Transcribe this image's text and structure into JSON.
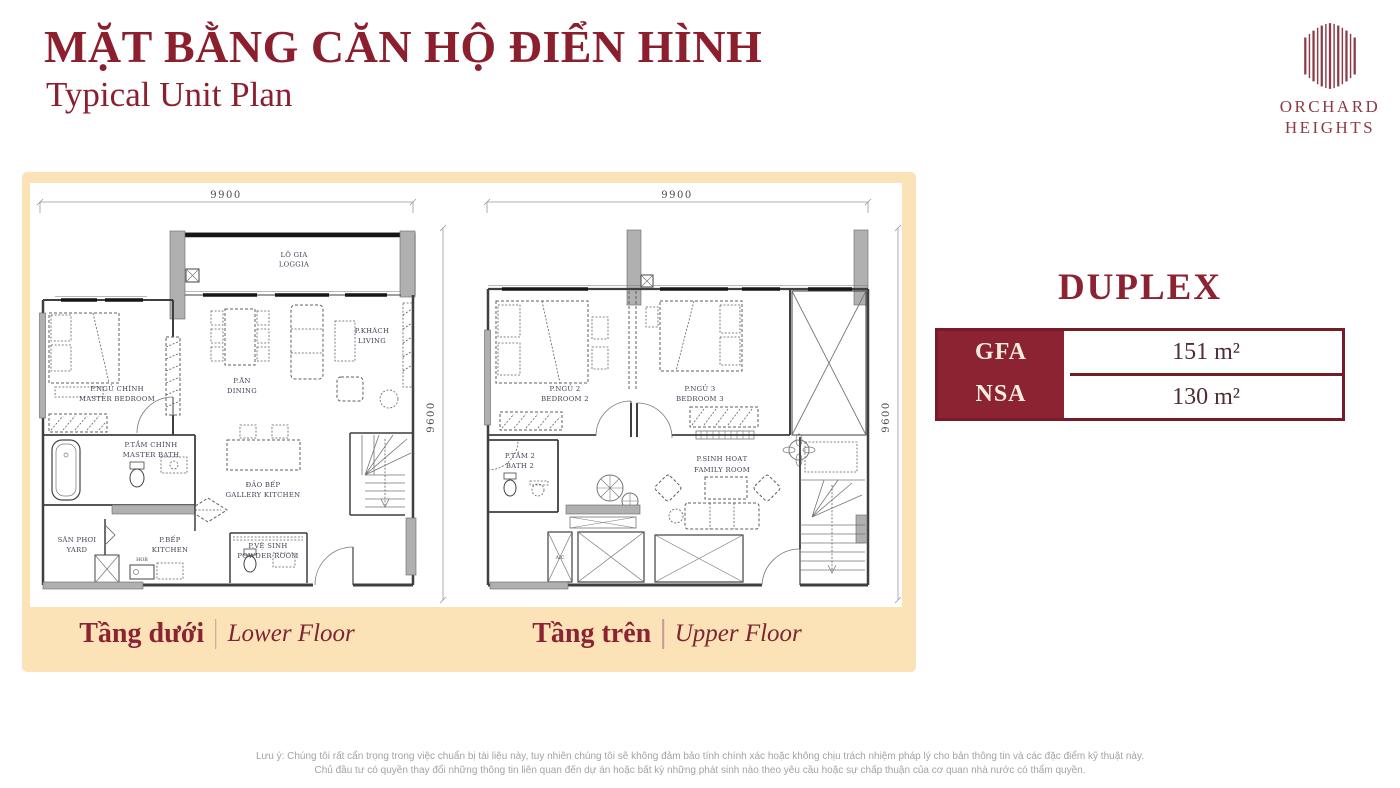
{
  "header": {
    "title_vi": "MẶT BẰNG CĂN HỘ ĐIỂN HÌNH",
    "title_en": "Typical Unit Plan"
  },
  "logo": {
    "line1": "ORCHARD",
    "line2": "HEIGHTS"
  },
  "unit": {
    "type": "DUPLEX",
    "rows": [
      {
        "label": "GFA",
        "value": "151 m²"
      },
      {
        "label": "NSA",
        "value": "130 m²"
      }
    ]
  },
  "plans": [
    {
      "name_vi": "Tầng dưới",
      "name_en": "Lower Floor",
      "dims": {
        "width": "9900",
        "height": "9600"
      },
      "rooms": {
        "loggia": {
          "vi": "LÔ GIA",
          "en": "LOGGIA"
        },
        "master_bedroom": {
          "vi": "P.NGỦ CHÍNH",
          "en": "MASTER BEDROOM"
        },
        "dining": {
          "vi": "P.ĂN",
          "en": "DINING"
        },
        "living": {
          "vi": "P.KHÁCH",
          "en": "LIVING"
        },
        "master_bath": {
          "vi": "P.TẮM CHÍNH",
          "en": "MASTER BATH"
        },
        "gallery_kitchen": {
          "vi": "ĐẢO BẾP",
          "en": "GALLERY KITCHEN"
        },
        "yard": {
          "vi": "SÂN PHƠI",
          "en": "YARD"
        },
        "kitchen": {
          "vi": "P.BẾP",
          "en": "KITCHEN"
        },
        "hob": {
          "vi": "HOB",
          "en": ""
        },
        "powder_room": {
          "vi": "P.VỆ SINH",
          "en": "POWDER ROOM"
        }
      }
    },
    {
      "name_vi": "Tầng trên",
      "name_en": "Upper Floor",
      "dims": {
        "width": "9900",
        "height": "9600"
      },
      "rooms": {
        "bedroom2": {
          "vi": "P.NGỦ 2",
          "en": "BEDROOM 2"
        },
        "bedroom3": {
          "vi": "P.NGỦ 3",
          "en": "BEDROOM 3"
        },
        "bath2": {
          "vi": "P.TẮM 2",
          "en": "BATH 2"
        },
        "family_room": {
          "vi": "P.SINH HOẠT",
          "en": "FAMILY ROOM"
        },
        "ac": {
          "vi": "A/C",
          "en": ""
        }
      }
    }
  ],
  "disclaimer": {
    "line1": "Lưu ý: Chúng tôi rất cẩn trọng trong việc chuẩn bị tài liệu này, tuy nhiên chúng tôi sẽ không đảm bảo tính chính xác hoặc không chịu trách nhiệm pháp lý cho bản thông tin và các đặc điểm kỹ thuật này.",
    "line2": "Chủ đầu tư có quyền thay đổi những thông tin liên quan đến dự án hoặc bất kỳ những phát sinh nào theo yêu cầu hoặc sự chấp thuận của cơ quan nhà nước có thẩm quyền."
  },
  "colors": {
    "brand_red": "#8b2332",
    "panel_cream": "#fbe3b7",
    "plan_label_ink": "#3e4156",
    "disclaimer_gray": "#a6a29e"
  }
}
